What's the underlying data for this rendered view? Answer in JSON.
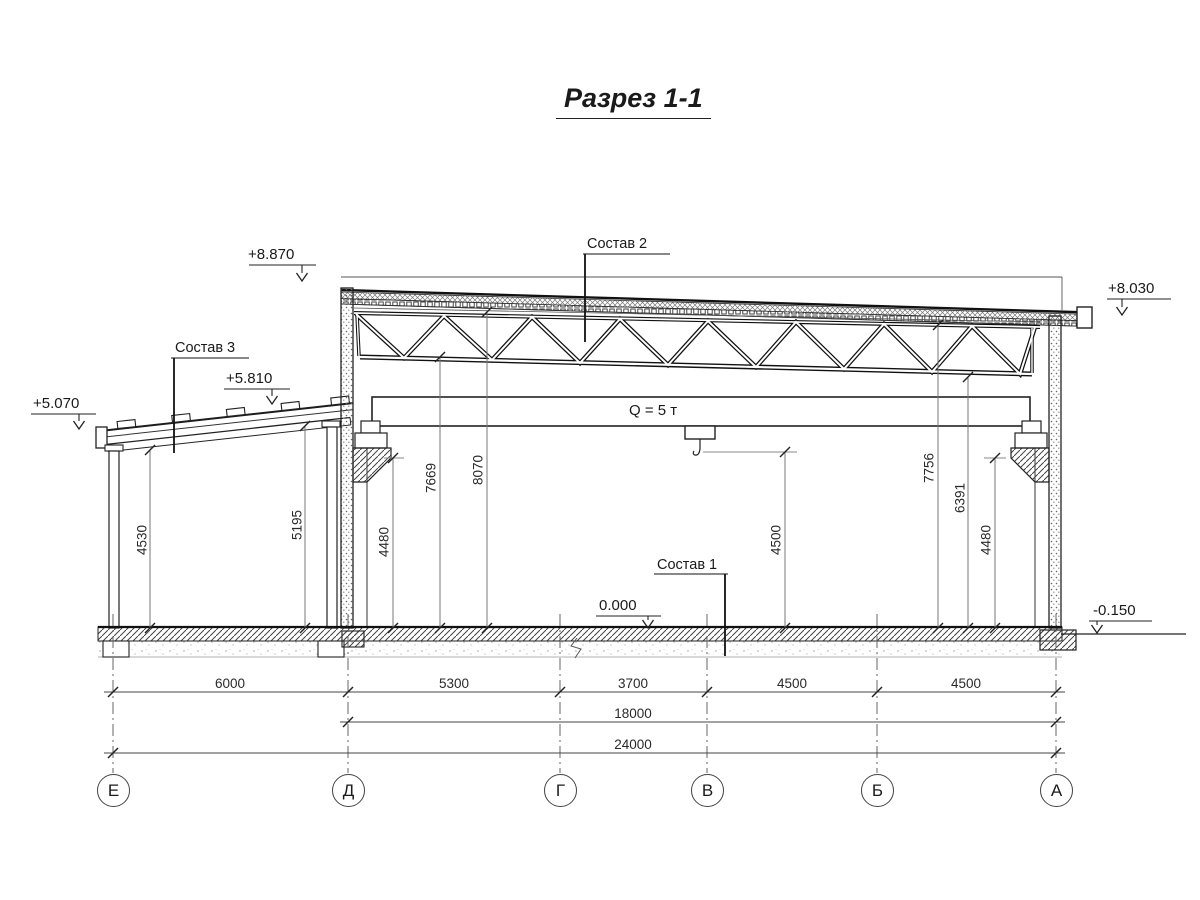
{
  "title": "Разрез 1-1",
  "elevation_marks": {
    "roof_left": "+8.870",
    "roof_right": "+8.030",
    "annex_roof_high": "+5.810",
    "annex_roof_low": "+5.070",
    "floor": "0.000",
    "ground": "-0.150"
  },
  "callouts": {
    "floor_composition": "Состав 1",
    "roof_composition": "Состав 2",
    "annex_roof_composition": "Состав 3"
  },
  "crane": {
    "capacity_label": "Q = 5 т"
  },
  "vertical_dims": {
    "annex_left": "4530",
    "annex_right": "5195",
    "crane_rail_left": "4480",
    "truss_bottom_left": "7669",
    "roof_underside_left": "8070",
    "hook_height": "4500",
    "roof_underside_right": "7756",
    "truss_bottom_right": "6391",
    "crane_rail_right": "4480"
  },
  "horizontal_dims": {
    "e_d": "6000",
    "d_g": "5300",
    "g_v": "3700",
    "v_b": "4500",
    "b_a": "4500",
    "d_a": "18000",
    "e_a": "24000"
  },
  "axes": [
    {
      "label": "Е"
    },
    {
      "label": "Д"
    },
    {
      "label": "Г"
    },
    {
      "label": "В"
    },
    {
      "label": "Б"
    },
    {
      "label": "А"
    }
  ]
}
